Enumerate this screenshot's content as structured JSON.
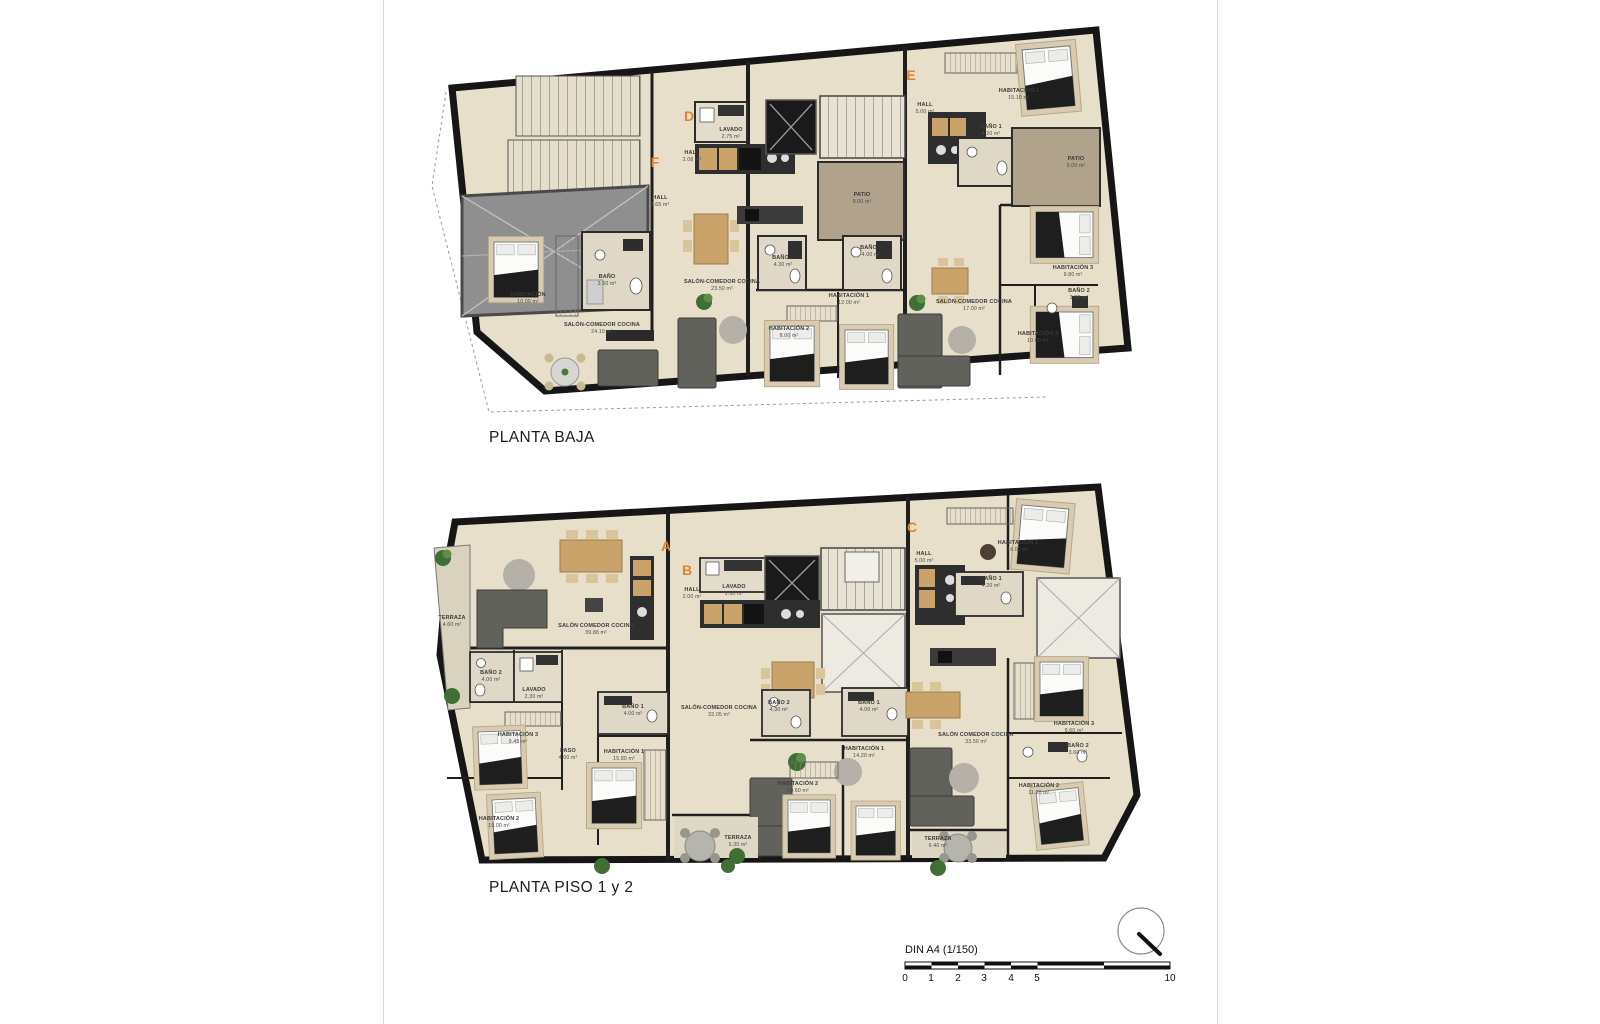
{
  "page": {
    "plan1_title": "PLANTA BAJA",
    "plan2_title": "PLANTA PISO 1 y 2",
    "scale_label": "DIN A4 (1/150)",
    "scale_ticks": [
      "0",
      "1",
      "2",
      "3",
      "4",
      "5",
      "10"
    ]
  },
  "colors": {
    "floor": "#e8dfca",
    "wall": "#1b1b1b",
    "patio": "#b1a28c",
    "light_patio": "#edeae1",
    "ramp": "#8f8f8f",
    "unit_letter": "#e0832c",
    "wood": "#c9a36a",
    "sofa": "#62625c"
  },
  "plan1": {
    "title": "PLANTA BAJA",
    "units": [
      {
        "letter": "F",
        "rooms": [
          {
            "name": "HALL",
            "area": "3.65 m²"
          },
          {
            "name": "HABITACIÓN",
            "area": "10.00 m²"
          },
          {
            "name": "BAÑO",
            "area": "3.50 m²"
          },
          {
            "name": "SALÓN-COMEDOR COCINA",
            "area": "24.10 m²"
          }
        ]
      },
      {
        "letter": "D",
        "rooms": [
          {
            "name": "LAVADO",
            "area": "2.75 m²"
          },
          {
            "name": "HALL",
            "area": "2.08 m²"
          },
          {
            "name": "SALÓN-COMEDOR COCINA",
            "area": "23.50 m²"
          },
          {
            "name": "BAÑO 2",
            "area": "4.30 m²"
          },
          {
            "name": "BAÑO 1",
            "area": "4.00 m²"
          },
          {
            "name": "PATIO",
            "area": "9.00 m²"
          },
          {
            "name": "HABITACIÓN 1",
            "area": "12.00 m²"
          },
          {
            "name": "HABITACIÓN 2",
            "area": "8.00 m²"
          }
        ]
      },
      {
        "letter": "E",
        "rooms": [
          {
            "name": "HALL",
            "area": "5.00 m²"
          },
          {
            "name": "HABITACIÓN 1",
            "area": "15.10 m²"
          },
          {
            "name": "BAÑO 1",
            "area": "4.20 m²"
          },
          {
            "name": "PATIO",
            "area": "9.00 m²"
          },
          {
            "name": "SALÓN-COMEDOR COCINA",
            "area": "17.00 m²"
          },
          {
            "name": "HABITACIÓN 3",
            "area": "9.80 m²"
          },
          {
            "name": "BAÑO 2",
            "area": "3.80 m²"
          },
          {
            "name": "HABITACIÓN 2",
            "area": "10.00 m²"
          }
        ]
      }
    ]
  },
  "plan2": {
    "title": "PLANTA PISO 1 y 2",
    "units": [
      {
        "letter": "A",
        "rooms": [
          {
            "name": "TERRAZA",
            "area": "4.60 m²"
          },
          {
            "name": "SALÓN COMEDOR COCINA",
            "area": "39.88 m²"
          },
          {
            "name": "BAÑO 2",
            "area": "4.00 m²"
          },
          {
            "name": "LAVADO",
            "area": "2.30 m²"
          },
          {
            "name": "HABITACIÓN 3",
            "area": "9.45 m²"
          },
          {
            "name": "PASO",
            "area": "4.00 m²"
          },
          {
            "name": "BAÑO 1",
            "area": "4.00 m²"
          },
          {
            "name": "HABITACIÓN 1",
            "area": "15.80 m²"
          },
          {
            "name": "HABITACIÓN 2",
            "area": "19.00 m²"
          }
        ]
      },
      {
        "letter": "B",
        "rooms": [
          {
            "name": "HALL",
            "area": "2.00 m²"
          },
          {
            "name": "LAVADO",
            "area": "1.50 m²"
          },
          {
            "name": "SALÓN-COMEDOR COCINA",
            "area": "32.05 m²"
          },
          {
            "name": "BAÑO 2",
            "area": "4.30 m²"
          },
          {
            "name": "BAÑO 1",
            "area": "4.00 m²"
          },
          {
            "name": "HABITACIÓN 1",
            "area": "14.20 m²"
          },
          {
            "name": "HABITACIÓN 2",
            "area": "10.60 m²"
          },
          {
            "name": "TERRAZA",
            "area": "5.30 m²"
          }
        ]
      },
      {
        "letter": "C",
        "rooms": [
          {
            "name": "HALL",
            "area": "5.00 m²"
          },
          {
            "name": "HABITACIÓN 1",
            "area": "16.00 m²"
          },
          {
            "name": "BAÑO 1",
            "area": "4.20 m²"
          },
          {
            "name": "SALÓN COMEDOR COCINA",
            "area": "33.50 m²"
          },
          {
            "name": "HABITACIÓN 3",
            "area": "9.60 m²"
          },
          {
            "name": "BAÑO 2",
            "area": "3.60 m²"
          },
          {
            "name": "HABITACIÓN 2",
            "area": "11.20 m²"
          },
          {
            "name": "TERRAZA",
            "area": "6.40 m²"
          }
        ]
      }
    ]
  }
}
